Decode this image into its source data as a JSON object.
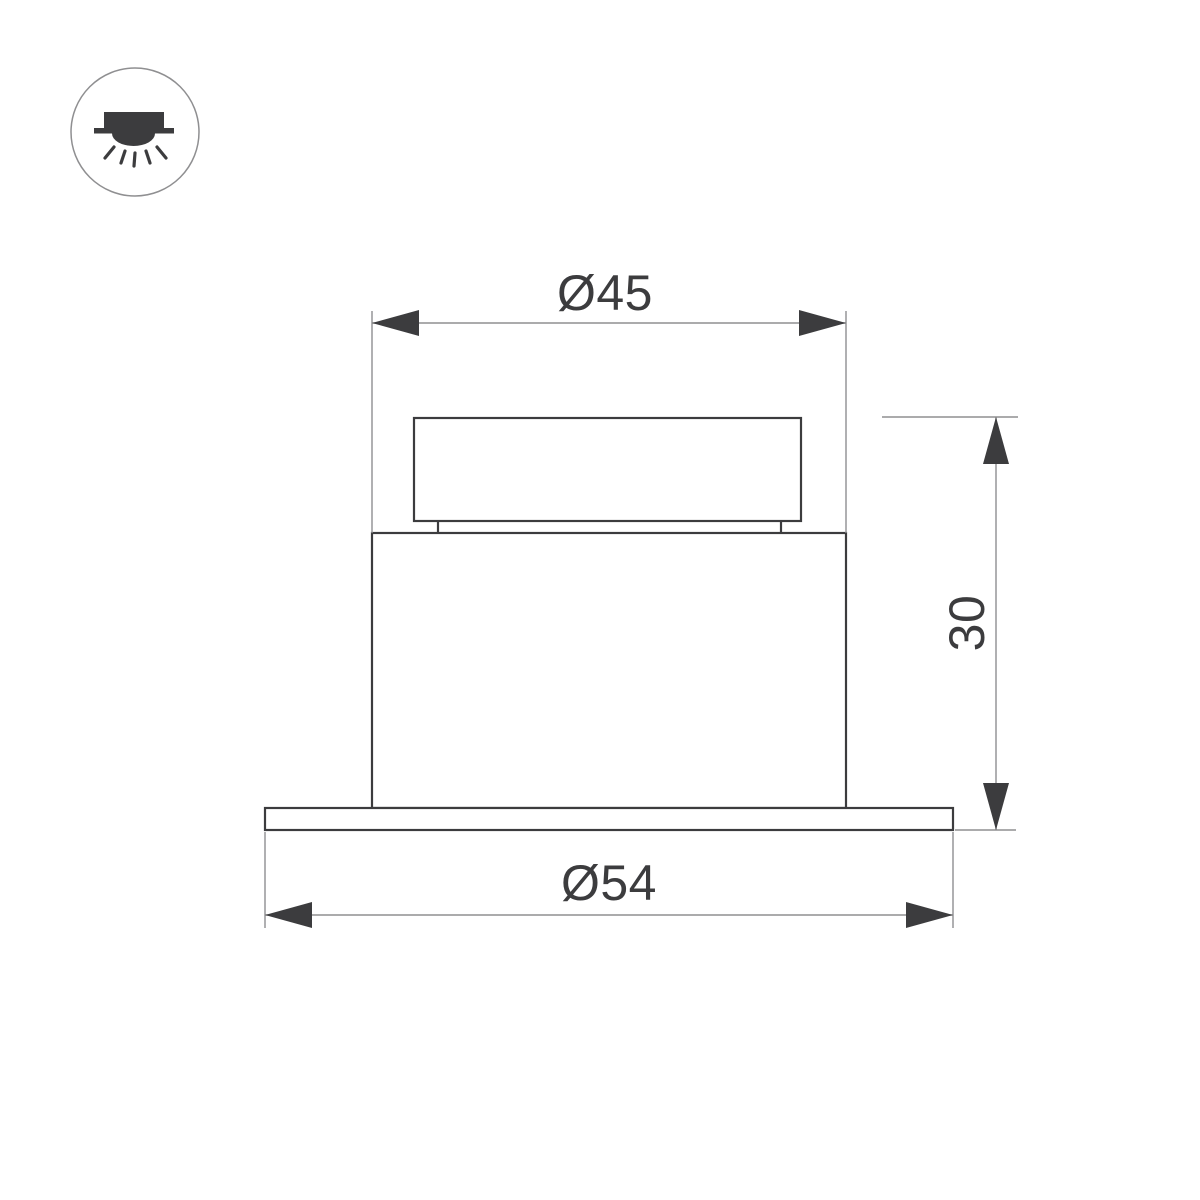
{
  "drawing": {
    "title": "recessed-downlight-dimension-drawing",
    "colors": {
      "background": "#ffffff",
      "outline": "#3c3c3e",
      "dimension_line": "#8f8f91",
      "text": "#3c3c3e"
    },
    "legend_icon": "recessed-ceiling-downlight",
    "dimensions": {
      "body_diameter": {
        "label": "Ø45",
        "value": 45,
        "orientation": "horizontal"
      },
      "height": {
        "label": "30",
        "value": 30,
        "orientation": "vertical"
      },
      "flange_diameter": {
        "label": "Ø54",
        "value": 54,
        "orientation": "horizontal"
      }
    }
  }
}
